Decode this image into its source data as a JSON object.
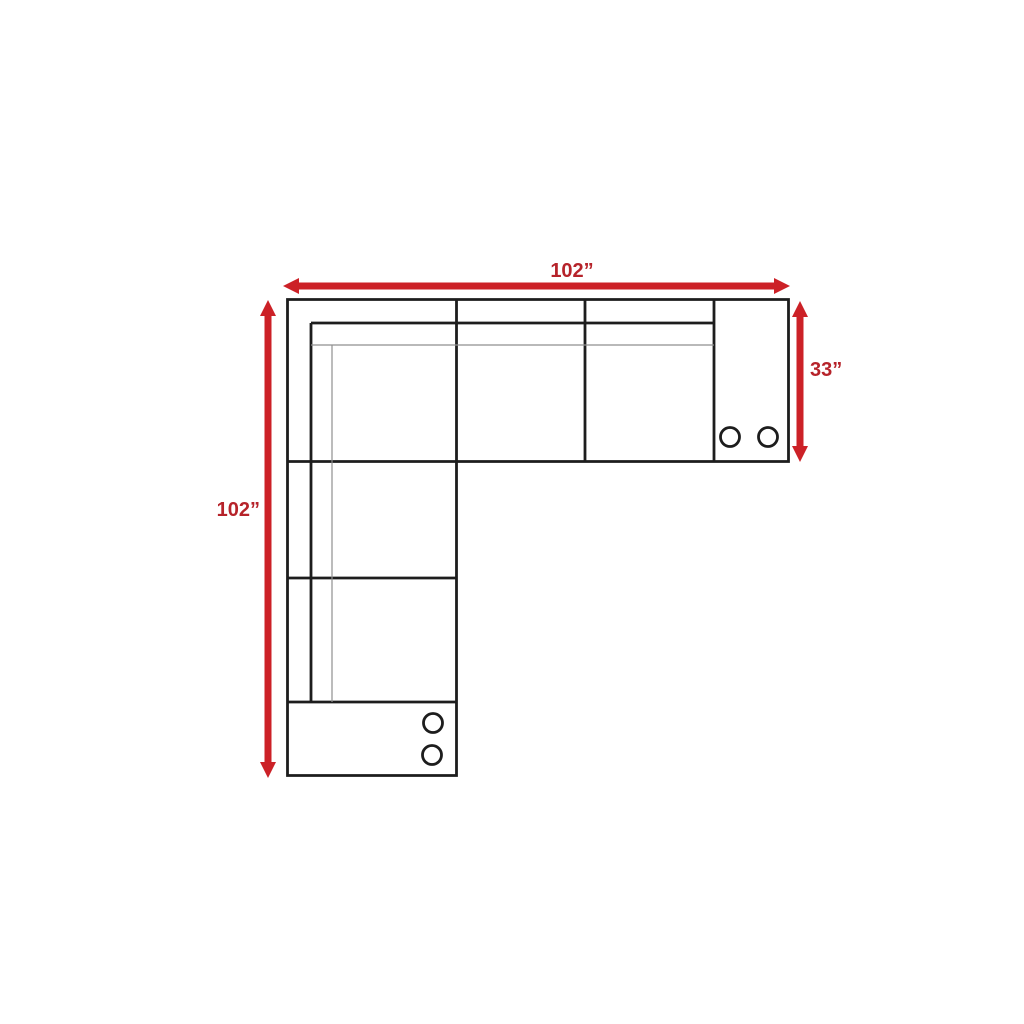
{
  "diagram": {
    "dimension_labels": {
      "top_width": "102”",
      "left_depth": "102”",
      "right_arm_depth": "33”"
    },
    "colors": {
      "arrow_red": "#cc2127",
      "label_red": "#b6232a",
      "line_black": "#1d1d1d",
      "line_thin_gray": "#8f8f8f",
      "background": "#ffffff"
    }
  }
}
